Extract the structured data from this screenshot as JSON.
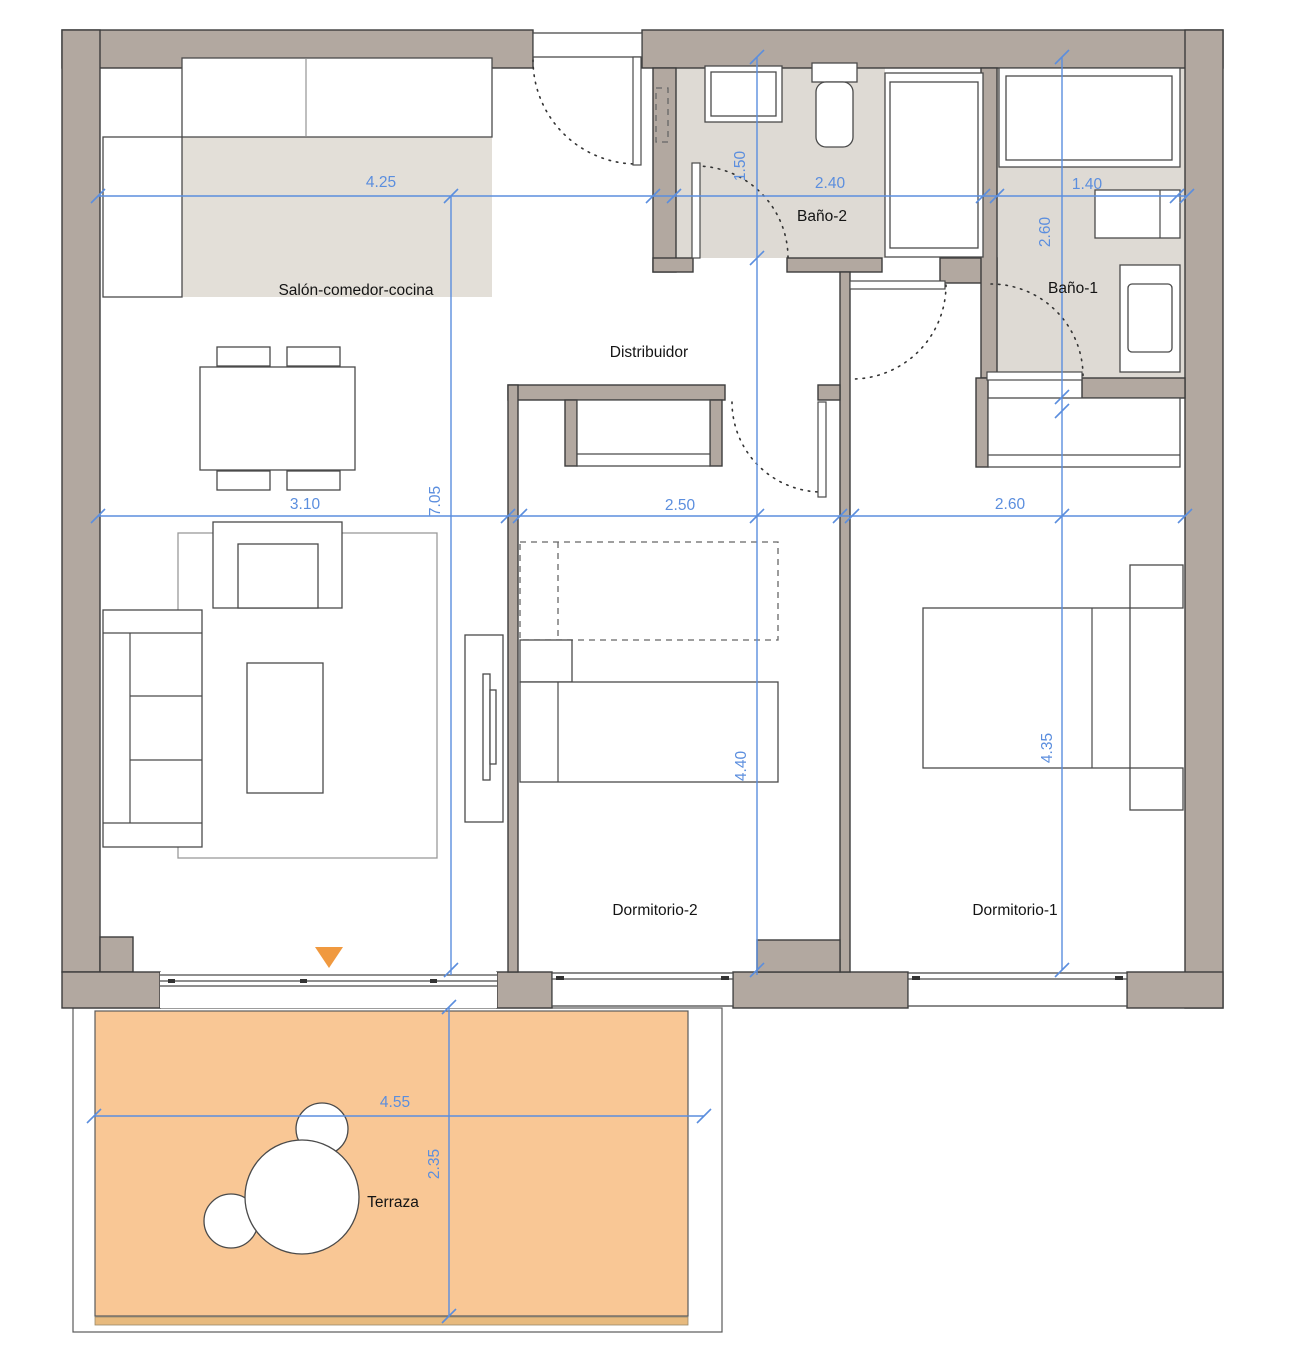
{
  "title": "Floor plan",
  "rooms": {
    "salon": {
      "label": "Salón-comedor-cocina"
    },
    "distribuidor": {
      "label": "Distribuidor"
    },
    "bano2": {
      "label": "Baño-2"
    },
    "bano1": {
      "label": "Baño-1"
    },
    "dorm2": {
      "label": "Dormitorio-2"
    },
    "dorm1": {
      "label": "Dormitorio-1"
    },
    "terraza": {
      "label": "Terraza"
    }
  },
  "dims": {
    "salon_width": {
      "value": "4.25"
    },
    "bano2_width": {
      "value": "2.40"
    },
    "bano1_width": {
      "value": "1.40"
    },
    "bano2_depth": {
      "value": "1.50"
    },
    "bano1_depth": {
      "value": "2.60"
    },
    "salon_inner": {
      "value": "3.10"
    },
    "salon_height": {
      "value": "7.05"
    },
    "dorm2_width": {
      "value": "2.50"
    },
    "dorm1_width": {
      "value": "2.60"
    },
    "dorm2_height": {
      "value": "4.40"
    },
    "dorm1_height": {
      "value": "4.35"
    },
    "terraza_width": {
      "value": "4.55"
    },
    "terraza_depth": {
      "value": "2.35"
    }
  },
  "icons": {
    "entrance_marker": "triangle-down-icon"
  },
  "colors": {
    "wall": "#b2a8a0",
    "bath_floor": "#dedad4",
    "kitchen_floor": "#e3dfd8",
    "terrace": "#f9c795",
    "dimension_blue": "#5b8ede",
    "entrance_marker_orange": "#f0993f"
  }
}
